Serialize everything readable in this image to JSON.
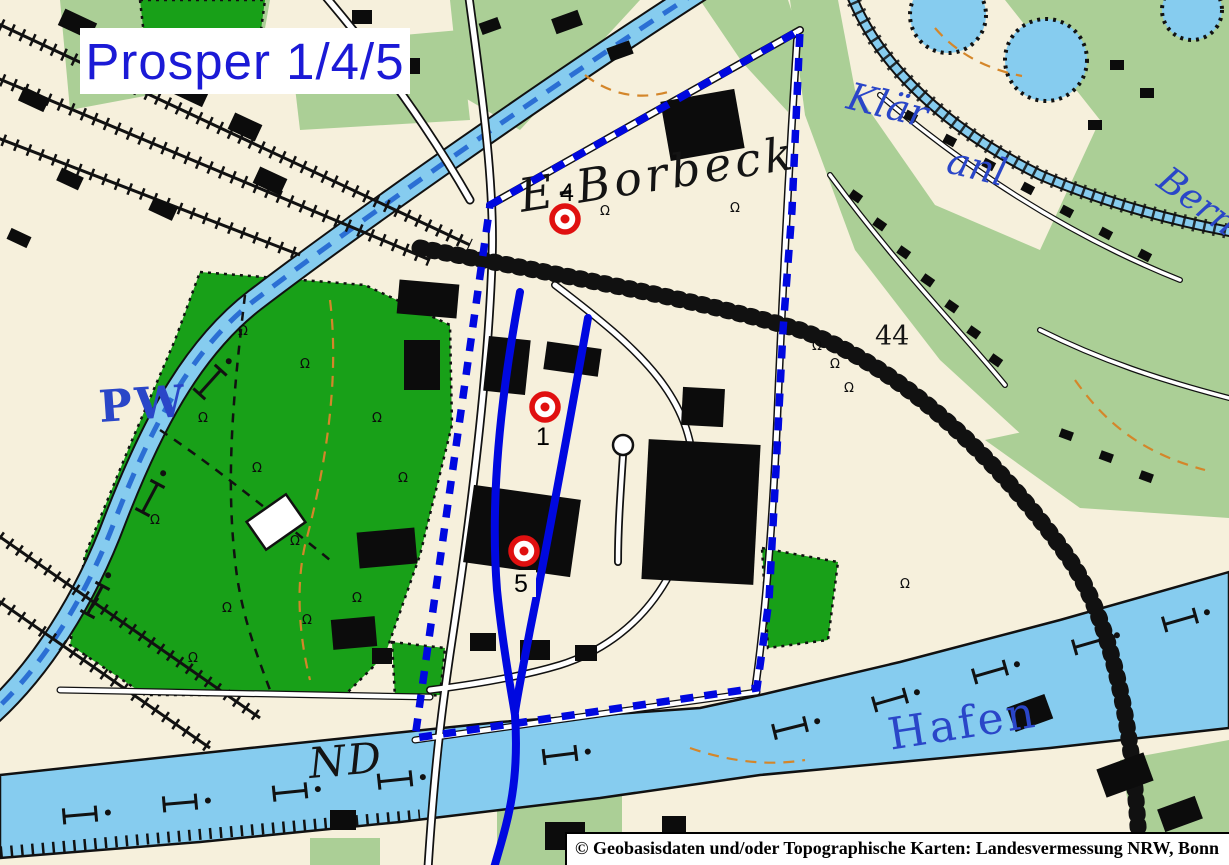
{
  "header": {
    "title": "Prosper 1/4/5"
  },
  "footer": {
    "attribution": "© Geobasisdaten und/oder Topographische Karten: Landesvermessung NRW, Bonn"
  },
  "markers": [
    {
      "label": "4",
      "x": 565,
      "y": 219
    },
    {
      "label": "1",
      "x": 545,
      "y": 407
    },
    {
      "label": "5",
      "x": 524,
      "y": 551
    }
  ],
  "map_labels": {
    "district": "E-Borbeck",
    "pumping_works": "PW",
    "sewage_plant_line1": "Klär",
    "sewage_plant_line2": "anl",
    "stream": "Berne",
    "harbor": "Hafen",
    "river_mark": "ND",
    "elevation": "44"
  },
  "colors": {
    "overlay_blue": "#0008e0",
    "marker_red": "#e01010",
    "water_blue": "#86ccef",
    "park_green": "#18a018",
    "pale_green": "#abcf96",
    "background_cream": "#f6f0dc",
    "title_blue": "#1b1ad6",
    "water_label_blue": "#2a46c8"
  }
}
